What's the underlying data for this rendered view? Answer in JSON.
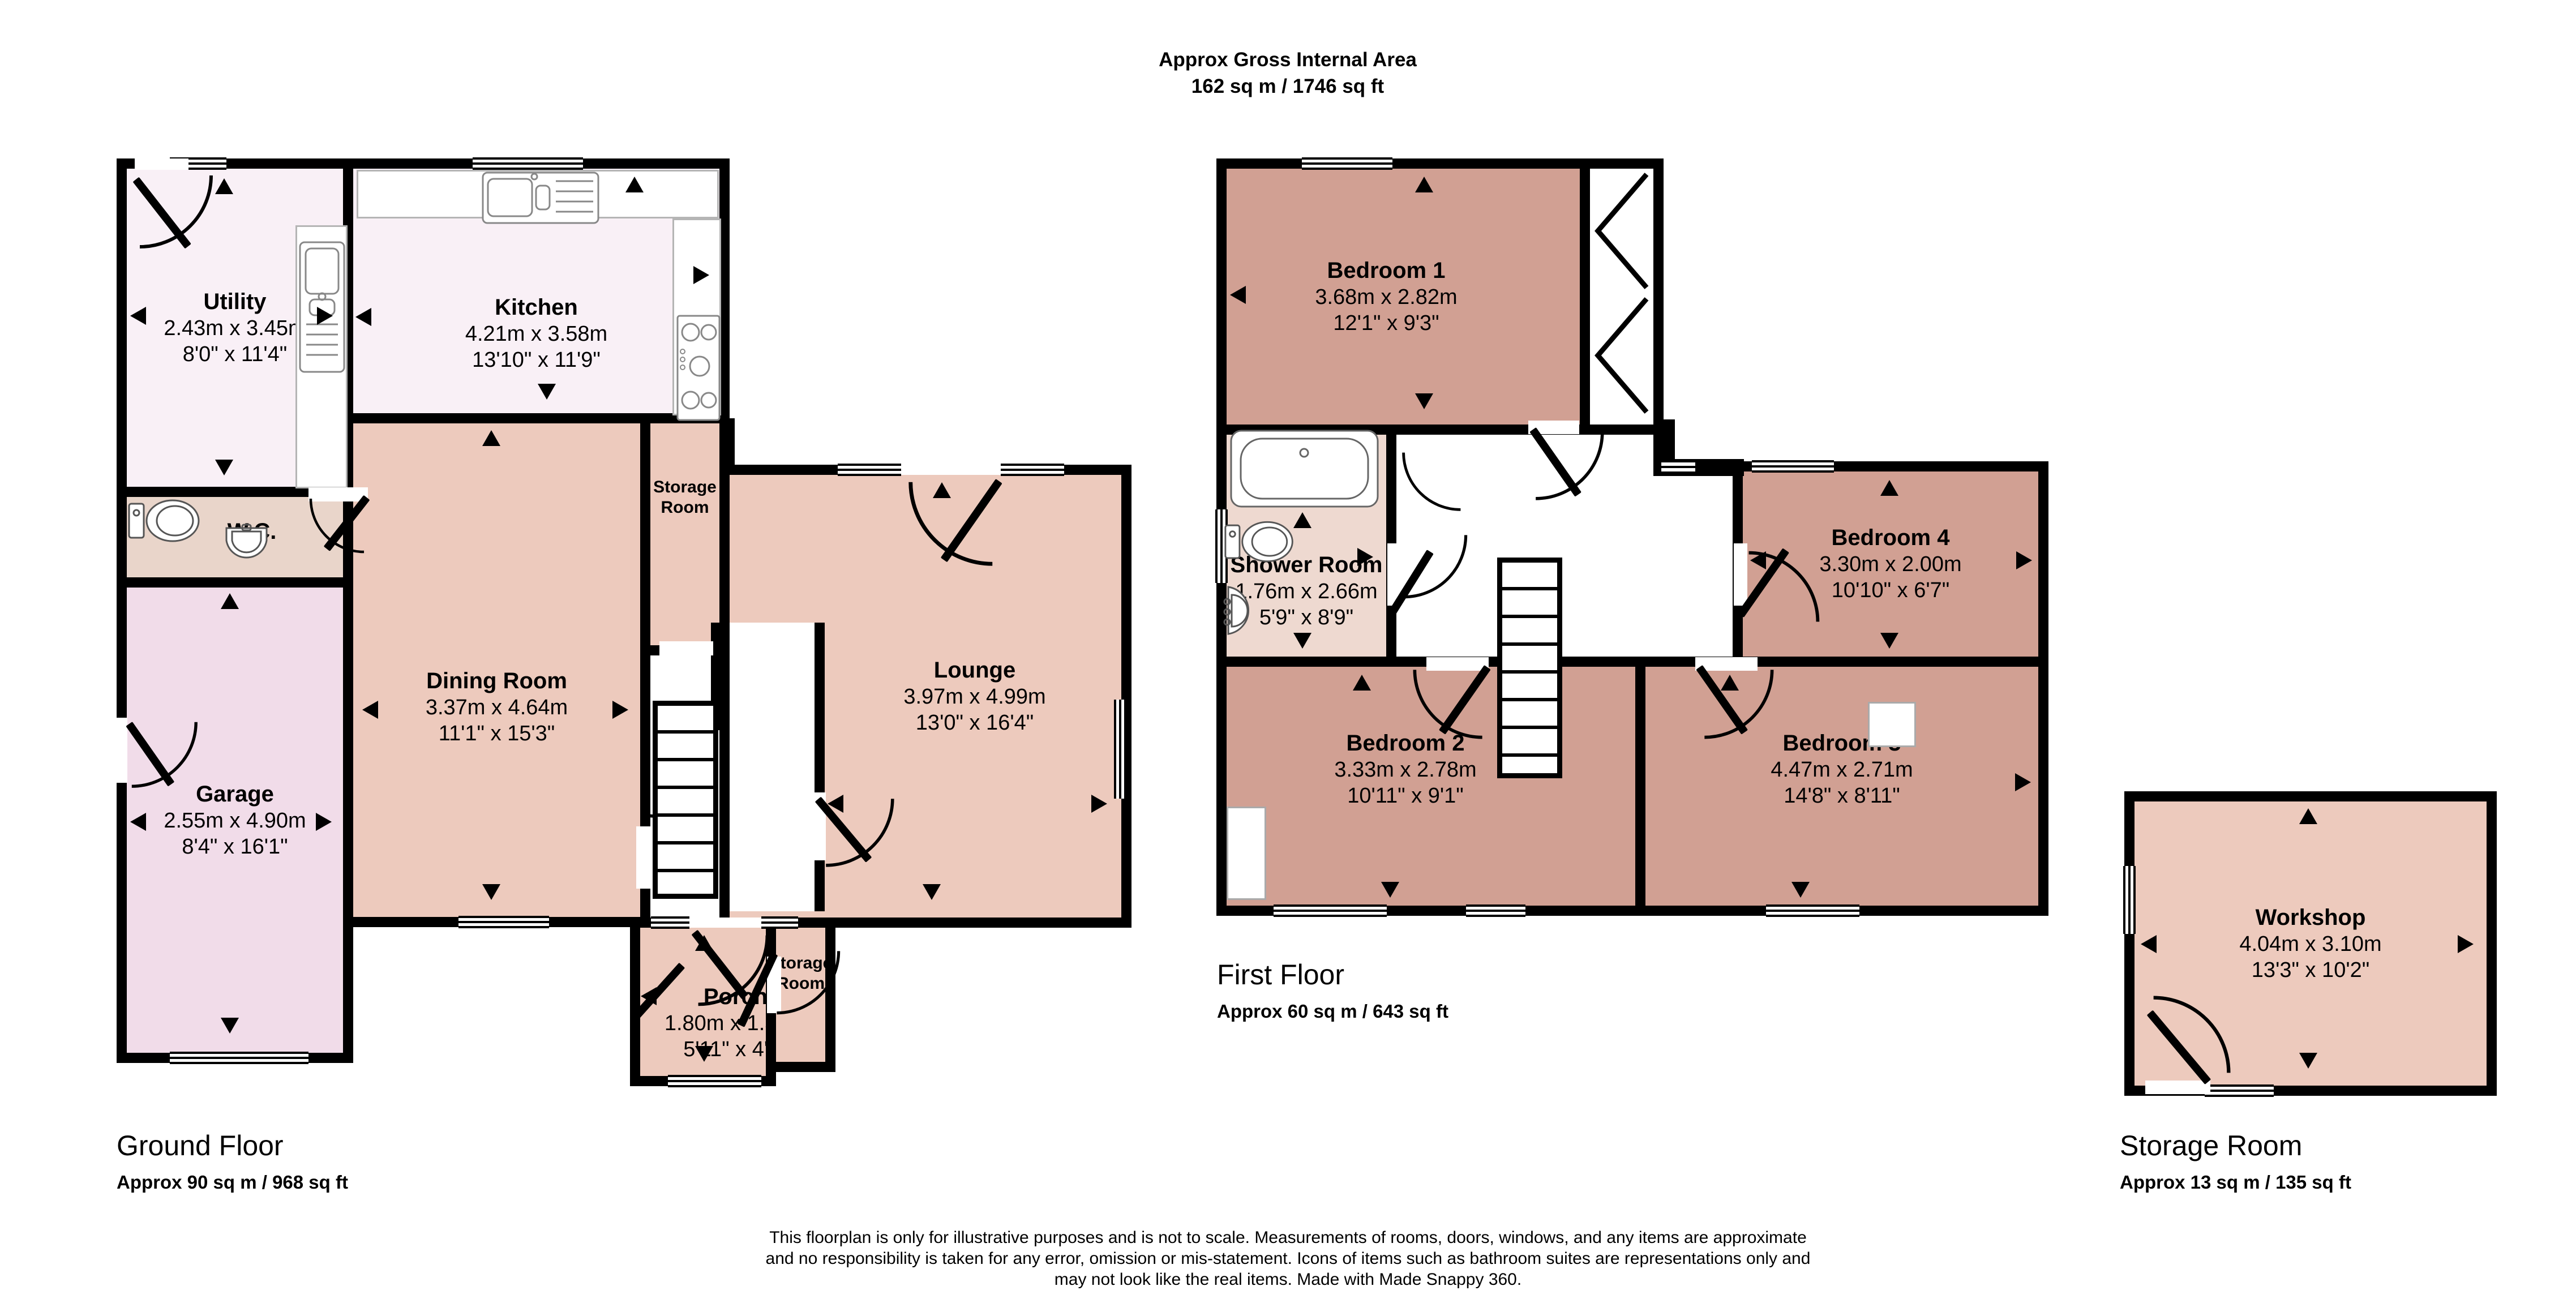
{
  "title": {
    "line1": "Approx Gross Internal Area",
    "line2": "162 sq m / 1746 sq ft"
  },
  "colors": {
    "pale": "#f9f0f6",
    "beige": "#e9d5ca",
    "garage": "#f1dce9",
    "salmon": "#edcabd",
    "rose": "#d1a093",
    "shower": "#eed9d0",
    "white": "#ffffff",
    "wall": "#000000"
  },
  "rooms": {
    "utility": {
      "name": "Utility",
      "metric": "2.43m x 3.45m",
      "imperial": "8'0\" x 11'4\""
    },
    "kitchen": {
      "name": "Kitchen",
      "metric": "4.21m x 3.58m",
      "imperial": "13'10\" x 11'9\""
    },
    "wc": {
      "name": "W.C."
    },
    "garage": {
      "name": "Garage",
      "metric": "2.55m x 4.90m",
      "imperial": "8'4\" x 16'1\""
    },
    "dining": {
      "name": "Dining Room",
      "metric": "3.37m x 4.64m",
      "imperial": "11'1\" x 15'3\""
    },
    "storage_upper": {
      "name": "Storage Room"
    },
    "lounge": {
      "name": "Lounge",
      "metric": "3.97m x 4.99m",
      "imperial": "13'0\" x 16'4\""
    },
    "porch": {
      "name": "Porch",
      "metric": "1.80m x 1.38m",
      "imperial": "5'11\" x 4'6\""
    },
    "storage_lower": {
      "name": "Storage Room"
    },
    "bedroom1": {
      "name": "Bedroom 1",
      "metric": "3.68m x 2.82m",
      "imperial": "12'1\" x 9'3\""
    },
    "shower": {
      "name": "Shower Room",
      "metric": "1.76m x 2.66m",
      "imperial": "5'9\" x 8'9\""
    },
    "bedroom4": {
      "name": "Bedroom 4",
      "metric": "3.30m x 2.00m",
      "imperial": "10'10\" x 6'7\""
    },
    "bedroom2": {
      "name": "Bedroom 2",
      "metric": "3.33m x 2.78m",
      "imperial": "10'11\" x 9'1\""
    },
    "bedroom3": {
      "name": "Bedroom 3",
      "metric": "4.47m x 2.71m",
      "imperial": "14'8\" x 8'11\""
    },
    "workshop": {
      "name": "Workshop",
      "metric": "4.04m x 3.10m",
      "imperial": "13'3\" x 10'2\""
    }
  },
  "floors": {
    "ground": {
      "label": "Ground Floor",
      "area": "Approx 90 sq m / 968 sq ft"
    },
    "first": {
      "label": "First Floor",
      "area": "Approx 60 sq m / 643 sq ft"
    },
    "storage": {
      "label": "Storage Room",
      "area": "Approx 13 sq m / 135 sq ft"
    }
  },
  "disclaimer": {
    "line1": "This floorplan is only for illustrative purposes and is not to scale. Measurements of rooms, doors, windows, and any items are approximate",
    "line2": "and no responsibility is taken for any error, omission or mis-statement. Icons of items such as bathroom suites are representations only and",
    "line3": "may not look like the real items. Made with Made Snappy 360."
  }
}
